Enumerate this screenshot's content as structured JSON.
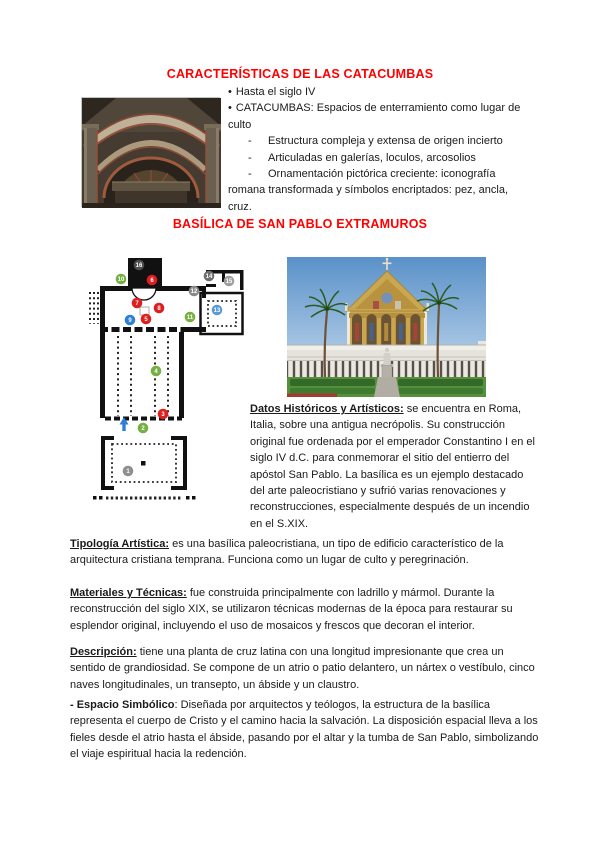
{
  "colors": {
    "heading": "#ff0000",
    "text": "#1a1a1a",
    "marker_red": "#dd1f1f",
    "marker_green": "#76b043",
    "marker_blue": "#2f7ed8",
    "marker_gray": "#8a8a8a"
  },
  "catacumbas": {
    "heading": "CARACTERÍSTICAS DE LAS CATACUMBAS",
    "items": [
      {
        "marker": "•",
        "text": "Hasta el siglo IV"
      },
      {
        "marker": "•",
        "text": "CATACUMBAS: Espacios de enterramiento como lugar de culto"
      },
      {
        "marker": "-",
        "text": "Estructura compleja y extensa de origen incierto"
      },
      {
        "marker": "-",
        "text": "Articuladas en galerías, loculos, arcosolios"
      },
      {
        "marker": "-",
        "text": "Ornamentación pictórica creciente: iconografía romana transformada y símbolos encriptados: pez, ancla, cruz."
      }
    ]
  },
  "basilica": {
    "heading": "BASÍLICA DE SAN PABLO EXTRAMUROS",
    "datos": {
      "lead": "Datos Históricos y Artísticos:",
      "text": " se encuentra en Roma, Italia, sobre una antigua necrópolis. Su construcción original fue ordenada por el emperador Constantino I en el siglo IV d.C. para conmemorar el sitio del entierro del apóstol San Pablo. La basílica es un ejemplo destacado del arte paleocristiano y sufrió varias renovaciones y reconstrucciones, especialmente después de un incendio en el S.XIX."
    }
  },
  "paragraphs": [
    {
      "lead": "Tipología Artística:",
      "text": " es una basílica paleocristiana, un tipo de edificio característico de la arquitectura cristiana temprana. Funciona como un lugar de culto y peregrinación."
    },
    {
      "lead": "Materiales y Técnicas:",
      "text": " fue construida principalmente con ladrillo y mármol. Durante la reconstrucción del siglo XIX, se utilizaron técnicas modernas de la época para restaurar su esplendor original, incluyendo el uso de mosaicos y frescos que decoran el interior."
    },
    {
      "lead": "Descripción:",
      "text": " tiene una planta de cruz latina con una longitud impresionante que crea un sentido de grandiosidad. Se compone de un atrio o patio delantero, un nártex o vestíbulo, cinco naves longitudinales, un transepto, un ábside y un claustro."
    },
    {
      "lead": "- Espacio Simbólico",
      "text": ": Diseñada por arquitectos y teólogos, la estructura de la basílica representa el cuerpo de Cristo y el camino hacia la salvación. La disposición espacial lleva a los fieles desde el atrio hasta el ábside, pasando por el altar y la tumba de San Pablo, simbolizando el viaje espiritual hacia la redención."
    }
  ],
  "plan": {
    "arrow_color": "#2f7ed8",
    "markers": [
      {
        "n": "1",
        "color": "#8f8f8f"
      },
      {
        "n": "2",
        "color": "#76b043"
      },
      {
        "n": "3",
        "color": "#dd1f1f"
      },
      {
        "n": "4",
        "color": "#76b043"
      },
      {
        "n": "5",
        "color": "#dd1f1f"
      },
      {
        "n": "6",
        "color": "#dd1f1f"
      },
      {
        "n": "7",
        "color": "#dd1f1f"
      },
      {
        "n": "8",
        "color": "#dd1f1f"
      },
      {
        "n": "9",
        "color": "#2f7ed8"
      },
      {
        "n": "10",
        "color": "#76b043"
      },
      {
        "n": "11",
        "color": "#76b043"
      },
      {
        "n": "12",
        "color": "#8a8a8a"
      },
      {
        "n": "13",
        "color": "#5b9bd5"
      },
      {
        "n": "14",
        "color": "#6e6e6e"
      },
      {
        "n": "15",
        "color": "#9e9e9e"
      },
      {
        "n": "16",
        "color": "#4d4d4d"
      }
    ]
  }
}
